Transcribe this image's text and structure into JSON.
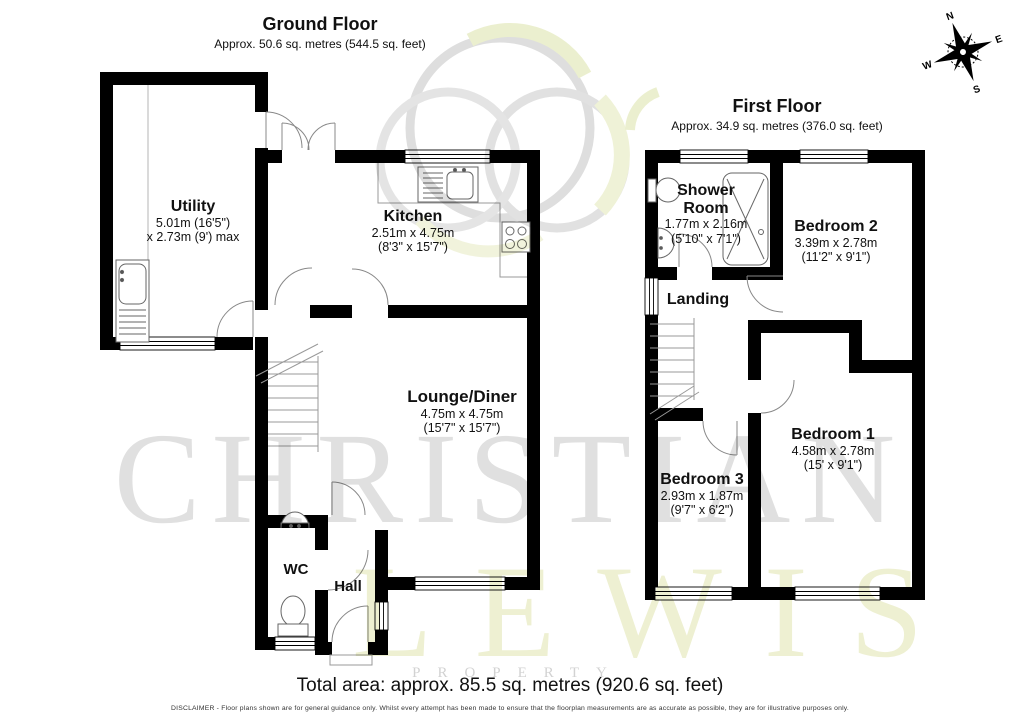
{
  "ground_floor": {
    "title": "Ground Floor",
    "subtitle": "Approx. 50.6 sq. metres (544.5 sq. feet)",
    "rooms": {
      "utility": {
        "name": "Utility",
        "dims1": "5.01m (16'5\")",
        "dims2": "x 2.73m (9') max"
      },
      "kitchen": {
        "name": "Kitchen",
        "dims1": "2.51m x 4.75m",
        "dims2": "(8'3\" x 15'7\")"
      },
      "lounge": {
        "name": "Lounge/Diner",
        "dims1": "4.75m x 4.75m",
        "dims2": "(15'7\" x 15'7\")"
      },
      "wc": {
        "name": "WC"
      },
      "hall": {
        "name": "Hall"
      }
    }
  },
  "first_floor": {
    "title": "First Floor",
    "subtitle": "Approx. 34.9 sq. metres (376.0 sq. feet)",
    "rooms": {
      "shower": {
        "name": "Shower Room",
        "dims1": "1.77m x 2.16m",
        "dims2": "(5'10\" x 7'1\")"
      },
      "bedroom2": {
        "name": "Bedroom 2",
        "dims1": "3.39m x 2.78m",
        "dims2": "(11'2\" x 9'1\")"
      },
      "landing": {
        "name": "Landing"
      },
      "bedroom1": {
        "name": "Bedroom 1",
        "dims1": "4.58m x 2.78m",
        "dims2": "(15' x 9'1\")"
      },
      "bedroom3": {
        "name": "Bedroom 3",
        "dims1": "2.93m x 1.87m",
        "dims2": "(9'7\" x 6'2\")"
      }
    }
  },
  "compass": {
    "n": "N",
    "e": "E",
    "s": "S",
    "w": "W"
  },
  "watermark": {
    "line1": "CHRISTIAN",
    "line2": "LEWIS",
    "line3": "PROPERTY"
  },
  "footer": {
    "total": "Total area: approx. 85.5 sq. metres (920.6 sq. feet)",
    "disclaimer": "DISCLAIMER -  Floor plans shown are for general guidance only. Whilst every attempt has been made to ensure that the floorplan measurements are as accurate as possible, they are for illustrative purposes only."
  },
  "colors": {
    "wall": "#000000",
    "watermark_gray": "#e0e0e0",
    "watermark_yellow": "#eef0d2"
  }
}
